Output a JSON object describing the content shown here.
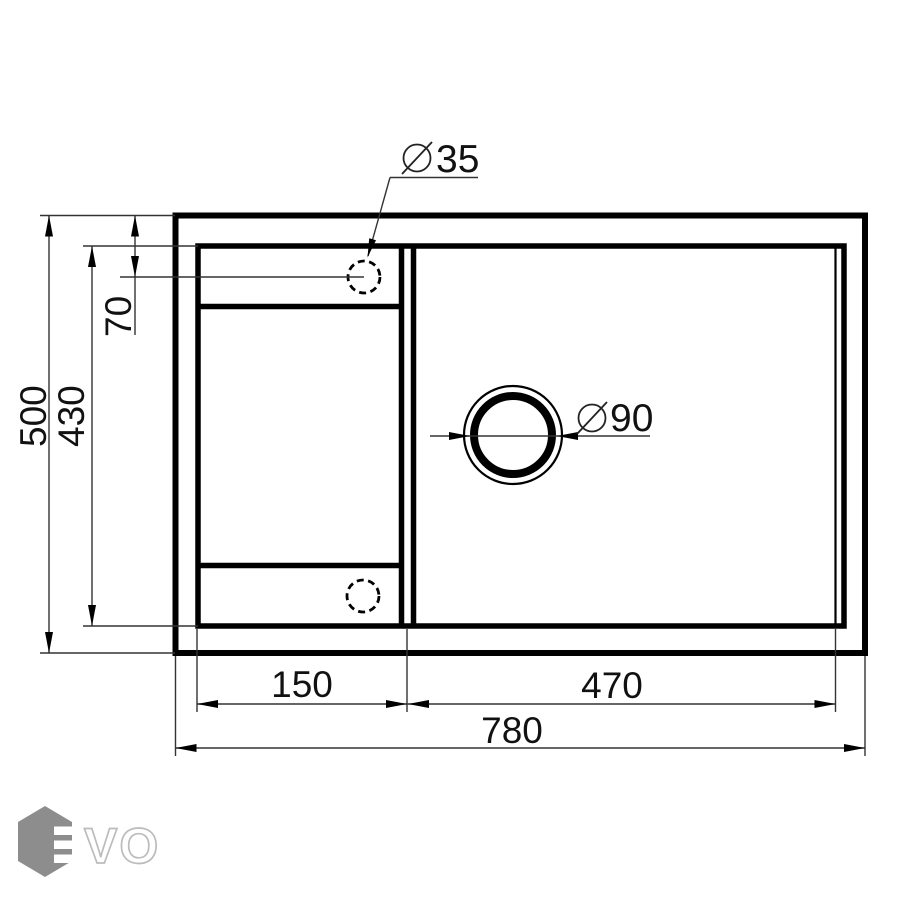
{
  "drawing": {
    "dim_overall_width": "780",
    "dim_overall_depth": "500",
    "dim_drainboard_width": "150",
    "dim_bowl_width": "470",
    "dim_bowl_depth": "430",
    "dim_tap_offset": "70",
    "dim_tap_hole_diameter": "35",
    "dim_drain_diameter": "90"
  },
  "logo": {
    "wordmark": "VO"
  },
  "colors": {
    "line_color": "#000000",
    "dim_line_color": "#333333",
    "text_color": "#111111",
    "logo_hex_color": "#8d8d8d",
    "logo_letter_outline": "#bcbcbc",
    "background": "#ffffff"
  }
}
